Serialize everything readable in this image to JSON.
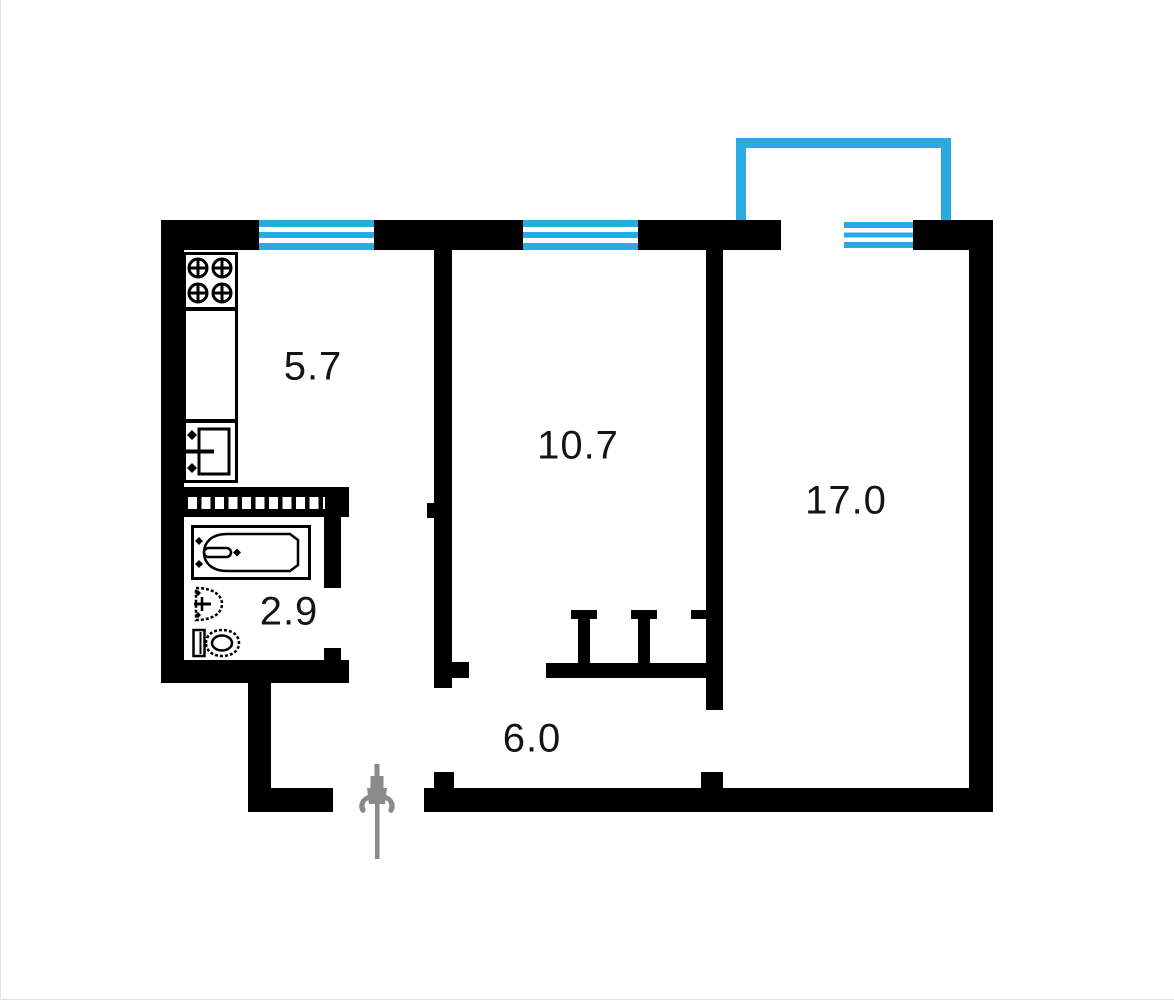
{
  "plan_type": "apartment-floor-plan",
  "rooms": {
    "kitchen": {
      "label": "5.7"
    },
    "living": {
      "label": "10.7"
    },
    "bedroom": {
      "label": "17.0"
    },
    "bathroom": {
      "label": "2.9"
    },
    "hallway": {
      "label": "6.0"
    }
  },
  "fixtures": [
    "stove-icon",
    "kitchen-sink-icon",
    "bathtub-icon",
    "washbasin-icon",
    "toilet-icon",
    "wardrobe-icon",
    "entrance-arrow-icon"
  ],
  "features": {
    "windows_count": 3,
    "balcony": true,
    "entrance": "bottom-left"
  },
  "colors": {
    "wall": "#000000",
    "window": "#29abe2",
    "balcony": "#29abe2",
    "entrance_arrow": "#8a8a8a",
    "label_text": "#141414",
    "background": "#ffffff"
  }
}
